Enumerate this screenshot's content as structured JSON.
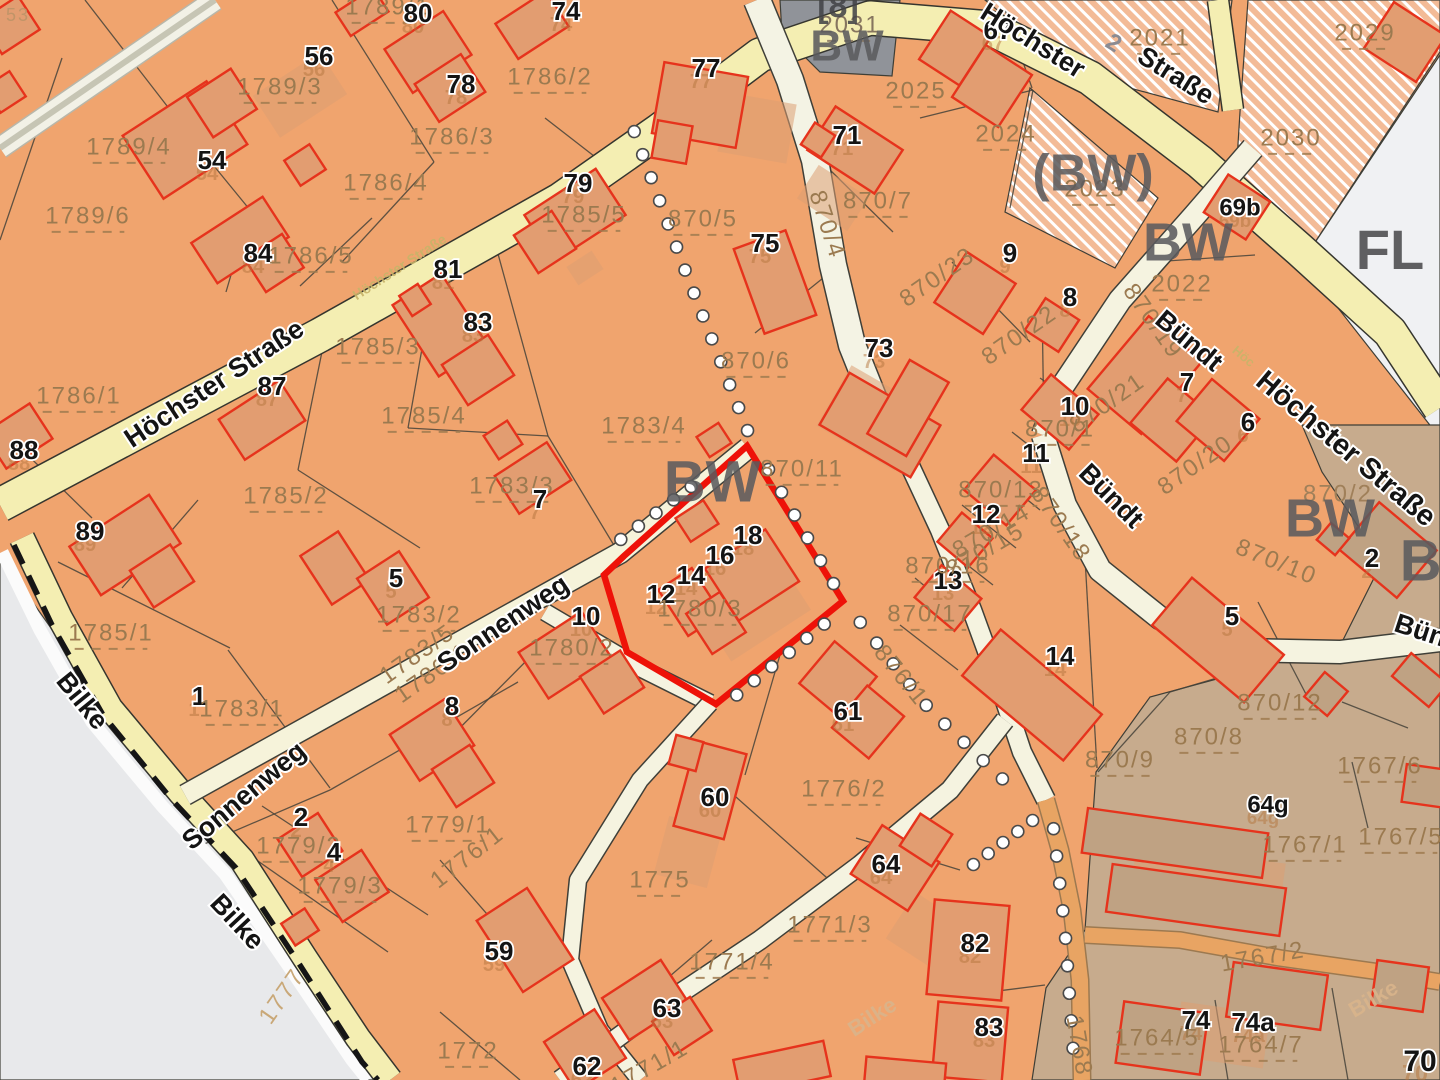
{
  "map": {
    "type": "cadastral-parcel-map",
    "highlight": {
      "parcel": "1780/3",
      "house_numbers": [
        "12",
        "14",
        "16",
        "18"
      ],
      "outline_color": "#ee1208"
    },
    "streets": [
      "Höchster Straße",
      "Sonnenweg",
      "Bündt",
      "Bilke"
    ],
    "zone_codes": [
      "BW",
      "(BW)",
      "FL",
      "[8]"
    ],
    "colors": {
      "parcel_base": "#f0a46e",
      "parcel_hatched": "#f3bb97",
      "zone_gray": "#909399",
      "zone_white": "#f0f1f3",
      "zone_brown": "#c7ab8d",
      "offmap_gray": "#e8e9eb",
      "road_yellow": "#f4eeb2",
      "road_cream": "#f5f3e0",
      "road_orange": "#e8a463",
      "building_stroke": "#e6331c",
      "building_fill": "#e29d71",
      "building_fill_brown": "#bfa283",
      "parcel_label": "#9b7a50",
      "house_label": "#141414",
      "zone_label": "#5b5b5e",
      "highlight": "#ee1208"
    },
    "labels": [
      {
        "t": "53",
        "k": "pr",
        "x": 18,
        "y": 16,
        "s": 18,
        "c": "#c09468"
      },
      {
        "t": "1789/1",
        "k": "p",
        "x": 388,
        "y": 8
      },
      {
        "t": "80",
        "k": "h",
        "x": 418,
        "y": 15
      },
      {
        "t": "74",
        "k": "h",
        "x": 566,
        "y": 13
      },
      {
        "t": "56",
        "k": "h",
        "x": 319,
        "y": 58
      },
      {
        "t": "1789/3",
        "k": "p",
        "x": 280,
        "y": 88
      },
      {
        "t": "1786/2",
        "k": "p",
        "x": 550,
        "y": 78
      },
      {
        "t": "78",
        "k": "h",
        "x": 461,
        "y": 86
      },
      {
        "t": "77",
        "k": "h",
        "x": 706,
        "y": 70
      },
      {
        "t": "67",
        "k": "h",
        "x": 998,
        "y": 32
      },
      {
        "t": "2031",
        "k": "p",
        "x": 850,
        "y": 26,
        "c": "#86755f"
      },
      {
        "t": "2021",
        "k": "p",
        "x": 1160,
        "y": 39
      },
      {
        "t": "2029",
        "k": "p",
        "x": 1365,
        "y": 34
      },
      {
        "t": "54",
        "k": "h",
        "x": 212,
        "y": 162
      },
      {
        "t": "1789/4",
        "k": "p",
        "x": 129,
        "y": 148
      },
      {
        "t": "1786/3",
        "k": "p",
        "x": 452,
        "y": 138
      },
      {
        "t": "2025",
        "k": "p",
        "x": 916,
        "y": 92
      },
      {
        "t": "1786/4",
        "k": "p",
        "x": 386,
        "y": 184
      },
      {
        "t": "79",
        "k": "h",
        "x": 578,
        "y": 185
      },
      {
        "t": "1785/5",
        "k": "p",
        "x": 584,
        "y": 216
      },
      {
        "t": "71",
        "k": "h",
        "x": 847,
        "y": 137
      },
      {
        "t": "2024",
        "k": "p",
        "x": 1006,
        "y": 135
      },
      {
        "t": "1789/6",
        "k": "p",
        "x": 88,
        "y": 217
      },
      {
        "t": "2023",
        "k": "p",
        "x": 1095,
        "y": 190
      },
      {
        "t": "2030",
        "k": "p",
        "x": 1291,
        "y": 139
      },
      {
        "t": "84",
        "k": "h",
        "x": 258,
        "y": 255
      },
      {
        "t": "1786/5",
        "k": "p",
        "x": 311,
        "y": 257
      },
      {
        "t": "870/5",
        "k": "p",
        "x": 703,
        "y": 220
      },
      {
        "t": "870/4",
        "k": "pr",
        "x": 826,
        "y": 225,
        "r": 72
      },
      {
        "t": "870/7",
        "k": "p",
        "x": 878,
        "y": 202
      },
      {
        "t": "75",
        "k": "h",
        "x": 765,
        "y": 245
      },
      {
        "t": "9",
        "k": "h",
        "x": 1010,
        "y": 255
      },
      {
        "t": "69b",
        "k": "h",
        "x": 1240,
        "y": 209,
        "s": 24
      },
      {
        "t": "870/23",
        "k": "pr",
        "x": 938,
        "y": 278,
        "r": -35
      },
      {
        "t": "81",
        "k": "h",
        "x": 448,
        "y": 271
      },
      {
        "t": "2022",
        "k": "p",
        "x": 1182,
        "y": 285
      },
      {
        "t": "8",
        "k": "h",
        "x": 1070,
        "y": 299
      },
      {
        "t": "83",
        "k": "h",
        "x": 478,
        "y": 324
      },
      {
        "t": "1785/3",
        "k": "p",
        "x": 378,
        "y": 348
      },
      {
        "t": "73",
        "k": "h",
        "x": 879,
        "y": 350
      },
      {
        "t": "870/22",
        "k": "pr",
        "x": 1020,
        "y": 336,
        "r": -35
      },
      {
        "t": "87",
        "k": "h",
        "x": 272,
        "y": 388
      },
      {
        "t": "1786/1",
        "k": "p",
        "x": 79,
        "y": 397
      },
      {
        "t": "1785/4",
        "k": "p",
        "x": 424,
        "y": 417
      },
      {
        "t": "870/6",
        "k": "p",
        "x": 756,
        "y": 362
      },
      {
        "t": "870/21",
        "k": "pr",
        "x": 1108,
        "y": 404,
        "r": -35
      },
      {
        "t": "870/19",
        "k": "pr",
        "x": 1152,
        "y": 322,
        "r": 55
      },
      {
        "t": "7",
        "k": "h",
        "x": 1187,
        "y": 384
      },
      {
        "t": "6",
        "k": "h",
        "x": 1248,
        "y": 424
      },
      {
        "t": "88",
        "k": "h",
        "x": 24,
        "y": 452
      },
      {
        "t": "1783/4",
        "k": "p",
        "x": 644,
        "y": 427
      },
      {
        "t": "870/11",
        "k": "p",
        "x": 802,
        "y": 470
      },
      {
        "t": "10",
        "k": "h",
        "x": 1075,
        "y": 408
      },
      {
        "t": "870/1",
        "k": "p",
        "x": 1060,
        "y": 430
      },
      {
        "t": "870/20",
        "k": "pr",
        "x": 1196,
        "y": 466,
        "r": -35
      },
      {
        "t": "1783/3",
        "k": "p",
        "x": 512,
        "y": 487
      },
      {
        "t": "7",
        "k": "h",
        "x": 540,
        "y": 501
      },
      {
        "t": "11",
        "k": "h",
        "x": 1036,
        "y": 455
      },
      {
        "t": "870/13",
        "k": "p",
        "x": 1001,
        "y": 491
      },
      {
        "t": "89",
        "k": "h",
        "x": 90,
        "y": 533
      },
      {
        "t": "1785/2",
        "k": "p",
        "x": 286,
        "y": 497
      },
      {
        "t": "18",
        "k": "h",
        "x": 748,
        "y": 537
      },
      {
        "t": "16",
        "k": "h",
        "x": 720,
        "y": 557
      },
      {
        "t": "14",
        "k": "h",
        "x": 691,
        "y": 577
      },
      {
        "t": "12",
        "k": "h",
        "x": 661,
        "y": 596
      },
      {
        "t": "1780/3",
        "k": "p",
        "x": 700,
        "y": 610
      },
      {
        "t": "870/14",
        "k": "pr",
        "x": 992,
        "y": 532,
        "r": -30
      },
      {
        "t": "870/15",
        "k": "pr",
        "x": 986,
        "y": 551,
        "r": -30
      },
      {
        "t": "12",
        "k": "h",
        "x": 986,
        "y": 516
      },
      {
        "t": "13",
        "k": "h",
        "x": 948,
        "y": 582
      },
      {
        "t": "870/16",
        "k": "p",
        "x": 948,
        "y": 567
      },
      {
        "t": "870/2",
        "k": "pr",
        "x": 1338,
        "y": 495,
        "r": 0,
        "c": "#a0805a"
      },
      {
        "t": "2",
        "k": "h",
        "x": 1372,
        "y": 560
      },
      {
        "t": "5",
        "k": "h",
        "x": 396,
        "y": 580
      },
      {
        "t": "1783/2",
        "k": "p",
        "x": 419,
        "y": 616
      },
      {
        "t": "10",
        "k": "h",
        "x": 586,
        "y": 618
      },
      {
        "t": "870/17",
        "k": "p",
        "x": 930,
        "y": 615
      },
      {
        "t": "870/18",
        "k": "pr",
        "x": 1060,
        "y": 525,
        "r": 55
      },
      {
        "t": "870/10",
        "k": "pr",
        "x": 1276,
        "y": 563,
        "r": 22
      },
      {
        "t": "1783/5",
        "k": "pr",
        "x": 418,
        "y": 655,
        "r": -35
      },
      {
        "t": "1780/1",
        "k": "pr",
        "x": 433,
        "y": 674,
        "r": -35
      },
      {
        "t": "1780/2",
        "k": "p",
        "x": 572,
        "y": 649
      },
      {
        "t": "14",
        "k": "h",
        "x": 1060,
        "y": 658
      },
      {
        "t": "5",
        "k": "h",
        "x": 1232,
        "y": 618
      },
      {
        "t": "1",
        "k": "h",
        "x": 199,
        "y": 698
      },
      {
        "t": "1785/1",
        "k": "p",
        "x": 111,
        "y": 634
      },
      {
        "t": "1783/1",
        "k": "p",
        "x": 242,
        "y": 710
      },
      {
        "t": "8",
        "k": "h",
        "x": 452,
        "y": 708
      },
      {
        "t": "61",
        "k": "h",
        "x": 848,
        "y": 713
      },
      {
        "t": "876/1",
        "k": "pr",
        "x": 900,
        "y": 676,
        "r": 51
      },
      {
        "t": "1776/2",
        "k": "p",
        "x": 844,
        "y": 790
      },
      {
        "t": "870/9",
        "k": "p",
        "x": 1120,
        "y": 761
      },
      {
        "t": "870/8",
        "k": "p",
        "x": 1209,
        "y": 738
      },
      {
        "t": "870/12",
        "k": "p",
        "x": 1280,
        "y": 704
      },
      {
        "t": "2",
        "k": "h",
        "x": 301,
        "y": 819
      },
      {
        "t": "1779/2",
        "k": "p",
        "x": 299,
        "y": 847
      },
      {
        "t": "4",
        "k": "h",
        "x": 334,
        "y": 854
      },
      {
        "t": "1779/3",
        "k": "p",
        "x": 340,
        "y": 887
      },
      {
        "t": "1779/1",
        "k": "p",
        "x": 448,
        "y": 826
      },
      {
        "t": "1776/1",
        "k": "pr",
        "x": 468,
        "y": 858,
        "r": -38
      },
      {
        "t": "60",
        "k": "h",
        "x": 715,
        "y": 799
      },
      {
        "t": "64",
        "k": "h",
        "x": 886,
        "y": 866
      },
      {
        "t": "1775",
        "k": "p",
        "x": 660,
        "y": 881
      },
      {
        "t": "1771/3",
        "k": "p",
        "x": 830,
        "y": 926
      },
      {
        "t": "64g",
        "k": "h",
        "x": 1268,
        "y": 806,
        "s": 24
      },
      {
        "t": "1767/1",
        "k": "p",
        "x": 1305,
        "y": 846
      },
      {
        "t": "1767/5",
        "k": "p",
        "x": 1401,
        "y": 838
      },
      {
        "t": "1767/6",
        "k": "p",
        "x": 1380,
        "y": 767
      },
      {
        "t": "59",
        "k": "h",
        "x": 499,
        "y": 953
      },
      {
        "t": "1771/4",
        "k": "p",
        "x": 732,
        "y": 963
      },
      {
        "t": "82",
        "k": "h",
        "x": 975,
        "y": 945
      },
      {
        "t": "1777",
        "k": "pr",
        "x": 283,
        "y": 997,
        "r": -55,
        "c": "#c9a878"
      },
      {
        "t": "63",
        "k": "h",
        "x": 667,
        "y": 1010
      },
      {
        "t": "83",
        "k": "h",
        "x": 989,
        "y": 1029
      },
      {
        "t": "1767/2",
        "k": "pr",
        "x": 1263,
        "y": 958,
        "r": -10
      },
      {
        "t": "1768",
        "k": "pr",
        "x": 1078,
        "y": 1046,
        "r": 80
      },
      {
        "t": "62",
        "k": "h",
        "x": 587,
        "y": 1068
      },
      {
        "t": "1772",
        "k": "p",
        "x": 468,
        "y": 1052
      },
      {
        "t": "1771/1",
        "k": "pr",
        "x": 650,
        "y": 1068,
        "r": -30
      },
      {
        "t": "74",
        "k": "h",
        "x": 1196,
        "y": 1022
      },
      {
        "t": "74a",
        "k": "h",
        "x": 1253,
        "y": 1024
      },
      {
        "t": "1764/5",
        "k": "p",
        "x": 1157,
        "y": 1039
      },
      {
        "t": "1764/7",
        "k": "p",
        "x": 1261,
        "y": 1046
      },
      {
        "t": "70",
        "k": "h",
        "x": 1420,
        "y": 1063,
        "s": 30
      },
      {
        "t": "Höchster  Straße",
        "k": "st",
        "x": 215,
        "y": 385,
        "r": -33.5
      },
      {
        "t": "Höchster Straße",
        "k": "stf",
        "x": 400,
        "y": 268,
        "r": -33,
        "s": 14
      },
      {
        "t": "Höchster",
        "k": "st",
        "x": 1032,
        "y": 42,
        "r": 32
      },
      {
        "t": "2",
        "k": "g2",
        "x": 1113,
        "y": 44,
        "r": 32
      },
      {
        "t": "Straße",
        "k": "st",
        "x": 1175,
        "y": 77,
        "r": 32
      },
      {
        "t": "Höchster Straße",
        "k": "st",
        "x": 1345,
        "y": 450,
        "r": 40,
        "s": 29
      },
      {
        "t": "Höc",
        "k": "stf",
        "x": 1243,
        "y": 357,
        "r": 40,
        "s": 13
      },
      {
        "t": "Bündt",
        "k": "st",
        "x": 1188,
        "y": 342,
        "r": 40
      },
      {
        "t": "Bündt",
        "k": "st",
        "x": 1110,
        "y": 497,
        "r": 45
      },
      {
        "t": "Bündt",
        "k": "st",
        "x": 1432,
        "y": 636,
        "r": 18
      },
      {
        "t": "Sonnenweg",
        "k": "st",
        "x": 504,
        "y": 625,
        "r": -34
      },
      {
        "t": "Sonnenweg",
        "k": "st",
        "x": 245,
        "y": 797,
        "r": -40
      },
      {
        "t": "Bilke",
        "k": "st",
        "x": 81,
        "y": 702,
        "r": 51
      },
      {
        "t": "Bilke",
        "k": "st",
        "x": 236,
        "y": 923,
        "r": 47
      },
      {
        "t": "Bilke",
        "k": "stf",
        "x": 873,
        "y": 1018,
        "r": -33,
        "s": 22,
        "c": "#d9b48b"
      },
      {
        "t": "Bilke",
        "k": "stf",
        "x": 1374,
        "y": 1000,
        "r": -30,
        "s": 22,
        "c": "#d9b48b"
      },
      {
        "t": "[8]",
        "k": "z",
        "x": 838,
        "y": 8,
        "s": 34,
        "c": "#434347"
      },
      {
        "t": "BW",
        "k": "z",
        "x": 847,
        "y": 49,
        "s": 44
      },
      {
        "t": "(BW)",
        "k": "z",
        "x": 1093,
        "y": 177,
        "s": 52
      },
      {
        "t": "BW",
        "k": "z",
        "x": 1188,
        "y": 246,
        "s": 54
      },
      {
        "t": "FL",
        "k": "z",
        "x": 1390,
        "y": 254,
        "s": 56,
        "c": "#4a4a4c"
      },
      {
        "t": "BW",
        "k": "z",
        "x": 712,
        "y": 486,
        "s": 58
      },
      {
        "t": "BW",
        "k": "z",
        "x": 1330,
        "y": 522,
        "s": 54
      },
      {
        "t": "BW",
        "k": "z",
        "x": 1448,
        "y": 565,
        "s": 58
      }
    ]
  }
}
